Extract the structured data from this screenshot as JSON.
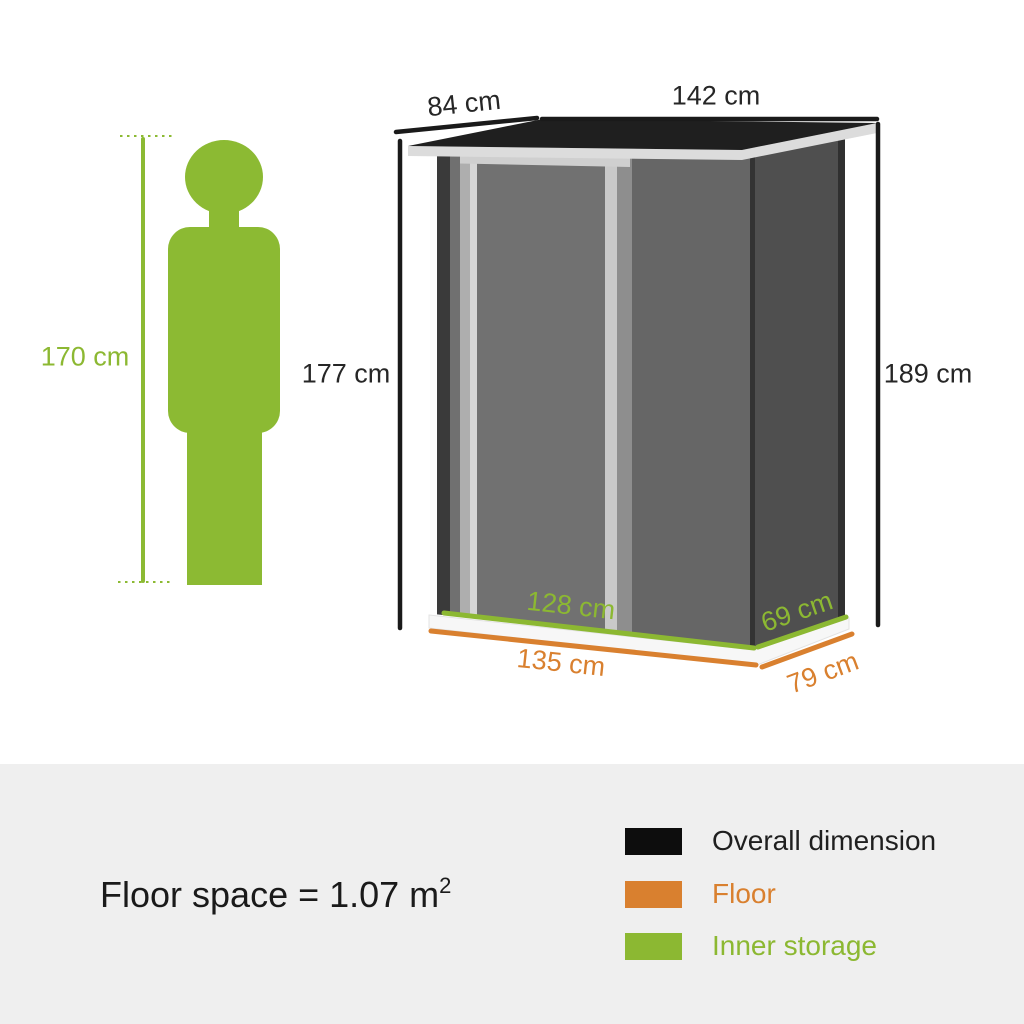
{
  "page": {
    "background": "#FFFFFF",
    "panel_background": "#EFEFEF"
  },
  "person": {
    "height_label": "170 cm",
    "color": "#8CBA33"
  },
  "shed": {
    "labels": {
      "roof_depth": "84 cm",
      "roof_width": "142 cm",
      "front_height": "177 cm",
      "back_height": "189 cm",
      "inner_width": "128 cm",
      "inner_depth": "69 cm",
      "floor_width": "135 cm",
      "floor_depth": "79 cm"
    },
    "colors": {
      "roof": "#1f1f1f",
      "roof_trim": "#dcdcdc",
      "front_wall": "#666666",
      "side_wall": "#4f4f4f",
      "door_frame": "#c9c9c9",
      "door_panel": "#717171"
    }
  },
  "summary": {
    "floor_space_main": "Floor space = 1.07 m",
    "floor_space_sup": "2"
  },
  "legend": {
    "items": [
      {
        "label": "Overall dimension",
        "color": "#0d0d0d"
      },
      {
        "label": "Floor",
        "color": "#D9802F"
      },
      {
        "label": "Inner storage",
        "color": "#8CB832"
      }
    ]
  }
}
